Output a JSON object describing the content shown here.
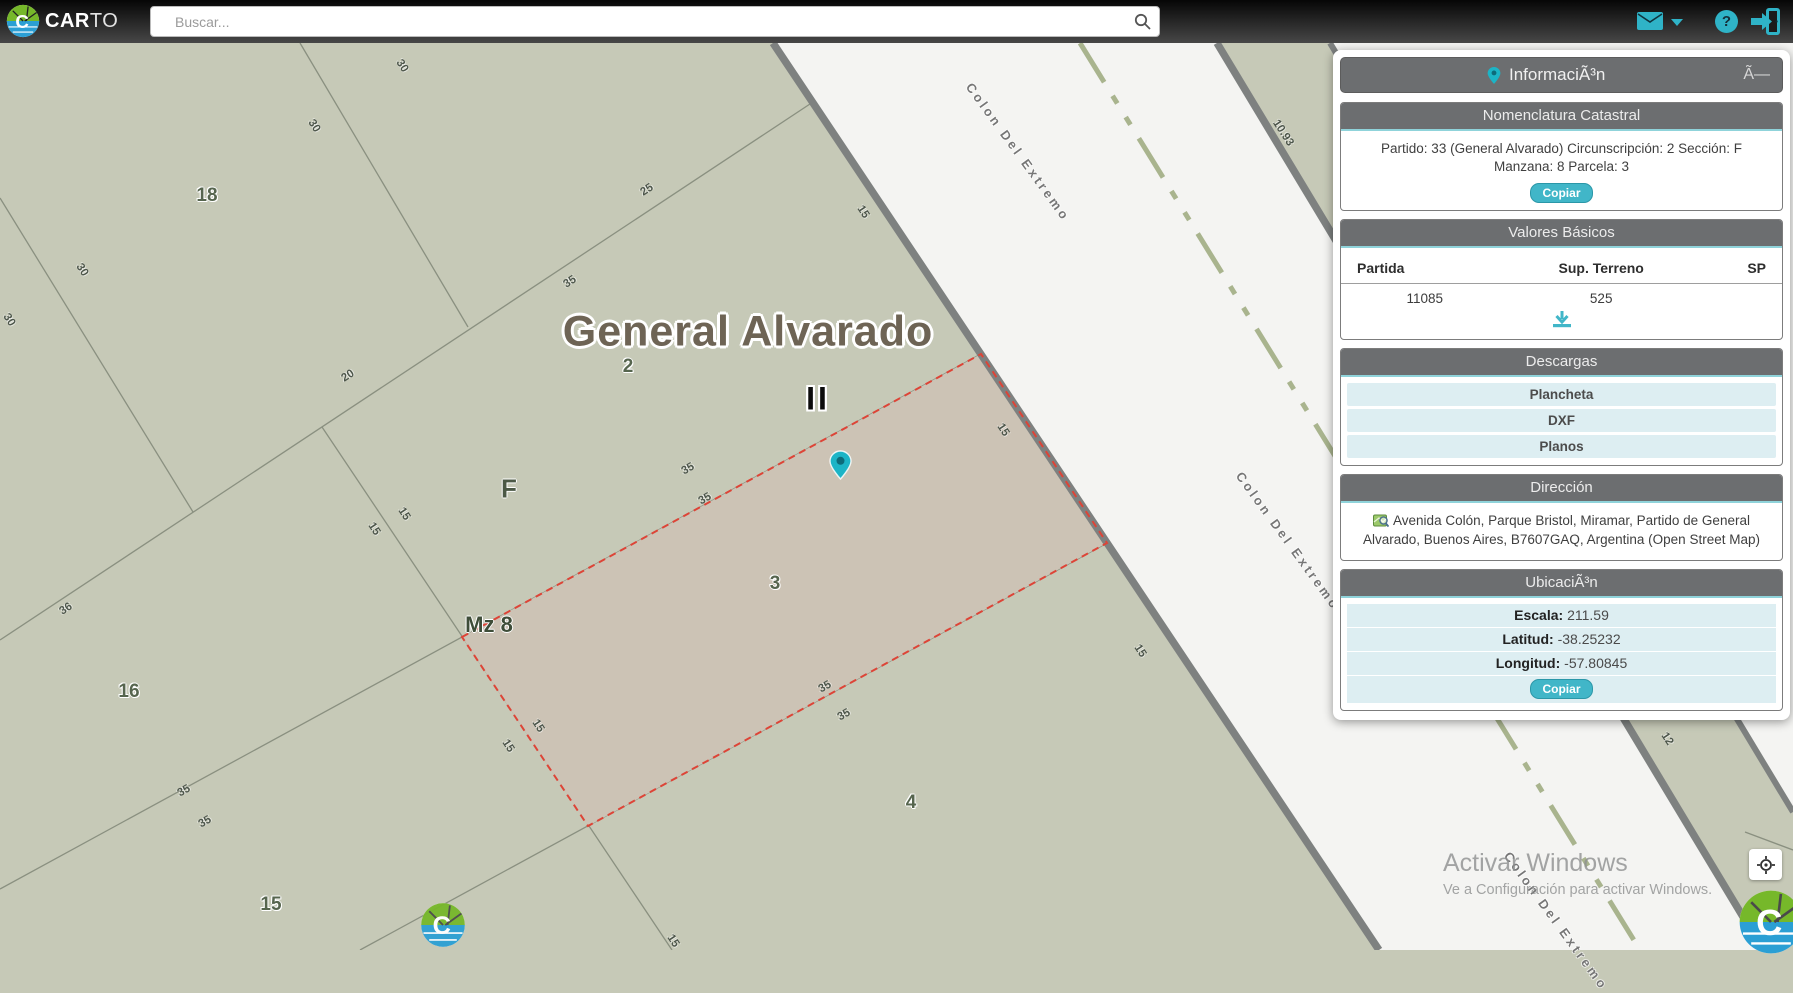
{
  "colors": {
    "accent": "#2fb3c7",
    "panel_header_bg": "#6c6e70",
    "panel_row_bg": "#ddeef2",
    "map_bg": "#c6c9b7",
    "road_fill": "#f4f4f2",
    "road_edge": "#7e8180",
    "parcel_fill": "#ccc3b5",
    "parcel_border": "#dd4437",
    "line_color": "#8a9080",
    "dash_line": "#a9b48e"
  },
  "topbar": {
    "logo_bold": "CAR",
    "logo_light": "TO",
    "search_placeholder": "Buscar...",
    "help_glyph": "?"
  },
  "panel": {
    "title": "InformaciÃ³n",
    "close_glyph": "Ã—",
    "nomenclatura": {
      "title": "Nomenclatura Catastral",
      "text": "Partido: 33 (General Alvarado) Circunscripción: 2 Sección: F Manzana: 8 Parcela: 3",
      "copy_label": "Copiar"
    },
    "valores": {
      "title": "Valores Básicos",
      "columns": [
        "Partida",
        "Sup. Terreno",
        "SP"
      ],
      "rows": [
        [
          "11085",
          "525",
          ""
        ]
      ]
    },
    "descargas": {
      "title": "Descargas",
      "items": [
        "Plancheta",
        "DXF",
        "Planos"
      ]
    },
    "direccion": {
      "title": "Dirección",
      "text": "Avenida Colón, Parque Bristol, Miramar, Partido de General Alvarado, Buenos Aires, B7607GAQ, Argentina (Open Street Map)"
    },
    "ubicacion": {
      "title": "UbicaciÃ³n",
      "rows": [
        {
          "label": "Escala:",
          "value": "211.59"
        },
        {
          "label": "Latitud:",
          "value": "-38.25232"
        },
        {
          "label": "Longitud:",
          "value": "-57.80845"
        }
      ],
      "copy_label": "Copiar"
    }
  },
  "map": {
    "pin": {
      "x": 840,
      "y": 461
    },
    "labels": [
      {
        "t": "General Alvarado",
        "x": 748,
        "y": 332,
        "r": 0,
        "c": "city"
      },
      {
        "t": "II",
        "x": 818,
        "y": 399,
        "r": 0,
        "c": "roman"
      },
      {
        "t": "2",
        "x": 628,
        "y": 367,
        "r": 0,
        "c": "parcel"
      },
      {
        "t": "3",
        "x": 775,
        "y": 584,
        "r": 0,
        "c": "parcel"
      },
      {
        "t": "4",
        "x": 911,
        "y": 803,
        "r": 0,
        "c": "parcel"
      },
      {
        "t": "18",
        "x": 207,
        "y": 196,
        "r": 0,
        "c": "parcel"
      },
      {
        "t": "16",
        "x": 129,
        "y": 692,
        "r": 0,
        "c": "parcel"
      },
      {
        "t": "15",
        "x": 271,
        "y": 905,
        "r": 0,
        "c": "parcel"
      },
      {
        "t": "F",
        "x": 509,
        "y": 489,
        "r": 0,
        "c": "section"
      },
      {
        "t": "Mz 8",
        "x": 489,
        "y": 625,
        "r": 0,
        "c": "block"
      },
      {
        "t": "30",
        "x": 402,
        "y": 66,
        "r": 57,
        "c": "dim"
      },
      {
        "t": "30",
        "x": 314,
        "y": 126,
        "r": 57,
        "c": "dim"
      },
      {
        "t": "30",
        "x": 82,
        "y": 270,
        "r": 57,
        "c": "dim"
      },
      {
        "t": "30",
        "x": 9,
        "y": 320,
        "r": 57,
        "c": "dim"
      },
      {
        "t": "20",
        "x": 348,
        "y": 376,
        "r": -33,
        "c": "dim"
      },
      {
        "t": "25",
        "x": 647,
        "y": 190,
        "r": -33,
        "c": "dim"
      },
      {
        "t": "35",
        "x": 570,
        "y": 282,
        "r": -33,
        "c": "dim"
      },
      {
        "t": "36",
        "x": 66,
        "y": 609,
        "r": -33,
        "c": "dim"
      },
      {
        "t": "35",
        "x": 688,
        "y": 469,
        "r": -30,
        "c": "dim"
      },
      {
        "t": "35",
        "x": 705,
        "y": 499,
        "r": -30,
        "c": "dim"
      },
      {
        "t": "35",
        "x": 825,
        "y": 687,
        "r": -30,
        "c": "dim"
      },
      {
        "t": "35",
        "x": 844,
        "y": 715,
        "r": -30,
        "c": "dim"
      },
      {
        "t": "35",
        "x": 184,
        "y": 791,
        "r": -30,
        "c": "dim"
      },
      {
        "t": "35",
        "x": 205,
        "y": 822,
        "r": -30,
        "c": "dim"
      },
      {
        "t": "15",
        "x": 404,
        "y": 514,
        "r": 57,
        "c": "dim"
      },
      {
        "t": "15",
        "x": 374,
        "y": 529,
        "r": 57,
        "c": "dim"
      },
      {
        "t": "15",
        "x": 538,
        "y": 726,
        "r": 57,
        "c": "dim"
      },
      {
        "t": "15",
        "x": 508,
        "y": 746,
        "r": 57,
        "c": "dim"
      },
      {
        "t": "15",
        "x": 673,
        "y": 941,
        "r": 57,
        "c": "dim"
      },
      {
        "t": "15",
        "x": 863,
        "y": 212,
        "r": 57,
        "c": "dim"
      },
      {
        "t": "15",
        "x": 1003,
        "y": 430,
        "r": 57,
        "c": "dim"
      },
      {
        "t": "15",
        "x": 1140,
        "y": 651,
        "r": 57,
        "c": "dim"
      },
      {
        "t": "10.93",
        "x": 1283,
        "y": 133,
        "r": 57,
        "c": "dim"
      },
      {
        "t": "12",
        "x": 1667,
        "y": 739,
        "r": 57,
        "c": "dim"
      },
      {
        "t": "Colon Del Extremo",
        "x": 1018,
        "y": 152,
        "r": 54,
        "c": "street"
      },
      {
        "t": "Colon Del Extremo",
        "x": 1288,
        "y": 541,
        "r": 54,
        "c": "street"
      },
      {
        "t": "Colon Del Extremo",
        "x": 1556,
        "y": 921,
        "r": 54,
        "c": "street"
      }
    ]
  },
  "watermark": {
    "line1": "Activar Windows",
    "line2": "Ve a Configuración para activar Windows."
  }
}
